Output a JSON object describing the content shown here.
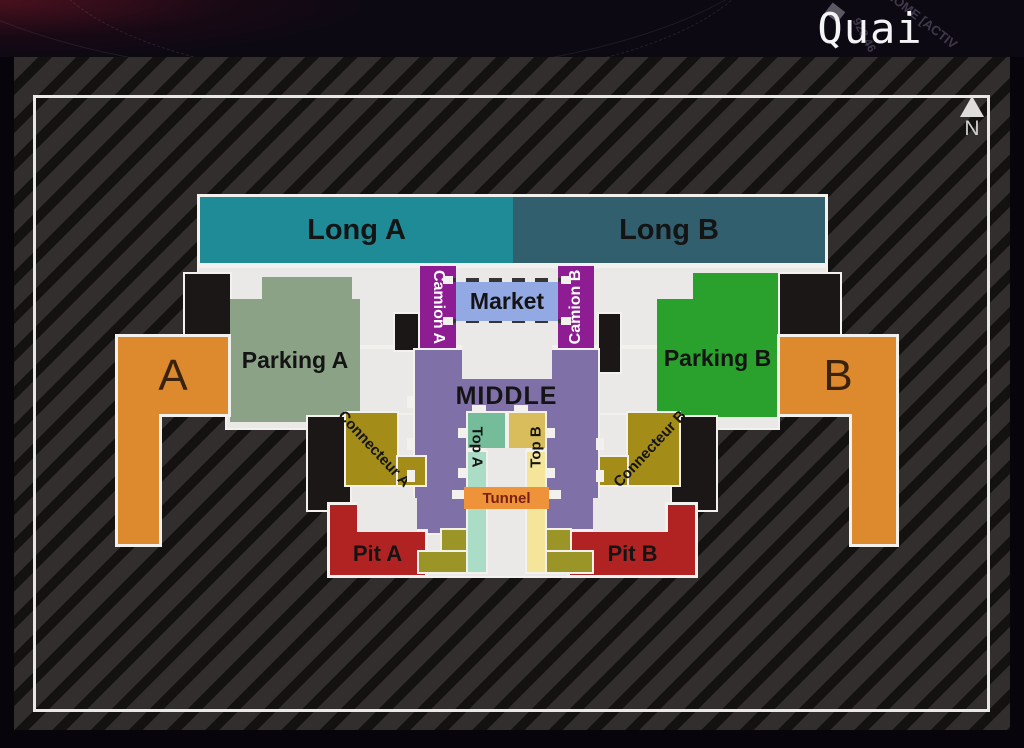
{
  "header": {
    "title": "Quai",
    "bg_text_primary": "GENOME [ACTIV",
    "bg_text_secondary": "928 46"
  },
  "map": {
    "north_label": "N",
    "zones": {
      "long_a": {
        "label": "Long A",
        "color": "#1e8b97"
      },
      "long_b": {
        "label": "Long B",
        "color": "#315f6d"
      },
      "camion_a": {
        "label": "Camion A",
        "color": "#8e1d94"
      },
      "camion_b": {
        "label": "Camion B",
        "color": "#8e1d94"
      },
      "market": {
        "label": "Market",
        "color": "#93a9e3"
      },
      "parking_a": {
        "label": "Parking A",
        "color": "#8ba287"
      },
      "parking_b": {
        "label": "Parking B",
        "color": "#2aa12c"
      },
      "middle": {
        "label": "MIDDLE",
        "color": "#7f70a7"
      },
      "top_a": {
        "label": "Top A",
        "color": "#74bc9a",
        "strip_color": "#abdcc6"
      },
      "top_b": {
        "label": "Top B",
        "color": "#d9bd5d",
        "strip_color": "#f4e59a"
      },
      "tunnel": {
        "label": "Tunnel",
        "color": "#ee9339"
      },
      "connecteur_a": {
        "label": "Connecteur A",
        "color": "#a38c17"
      },
      "connecteur_b": {
        "label": "Connecteur B",
        "color": "#a38c17"
      },
      "pit_a": {
        "label": "Pit A",
        "color": "#b12323"
      },
      "pit_b": {
        "label": "Pit B",
        "color": "#b12323"
      },
      "spawn_a": {
        "label": "A",
        "color": "#dc8a2d"
      },
      "spawn_b": {
        "label": "B",
        "color": "#dc8a2d"
      }
    },
    "palette": {
      "floor": "#ebe9e7",
      "walls": "#1b1717",
      "outline": "#f2f1ee",
      "olive_lower": "#9b9427",
      "stripe_light": "#322e2e",
      "stripe_dark": "#141111"
    }
  }
}
